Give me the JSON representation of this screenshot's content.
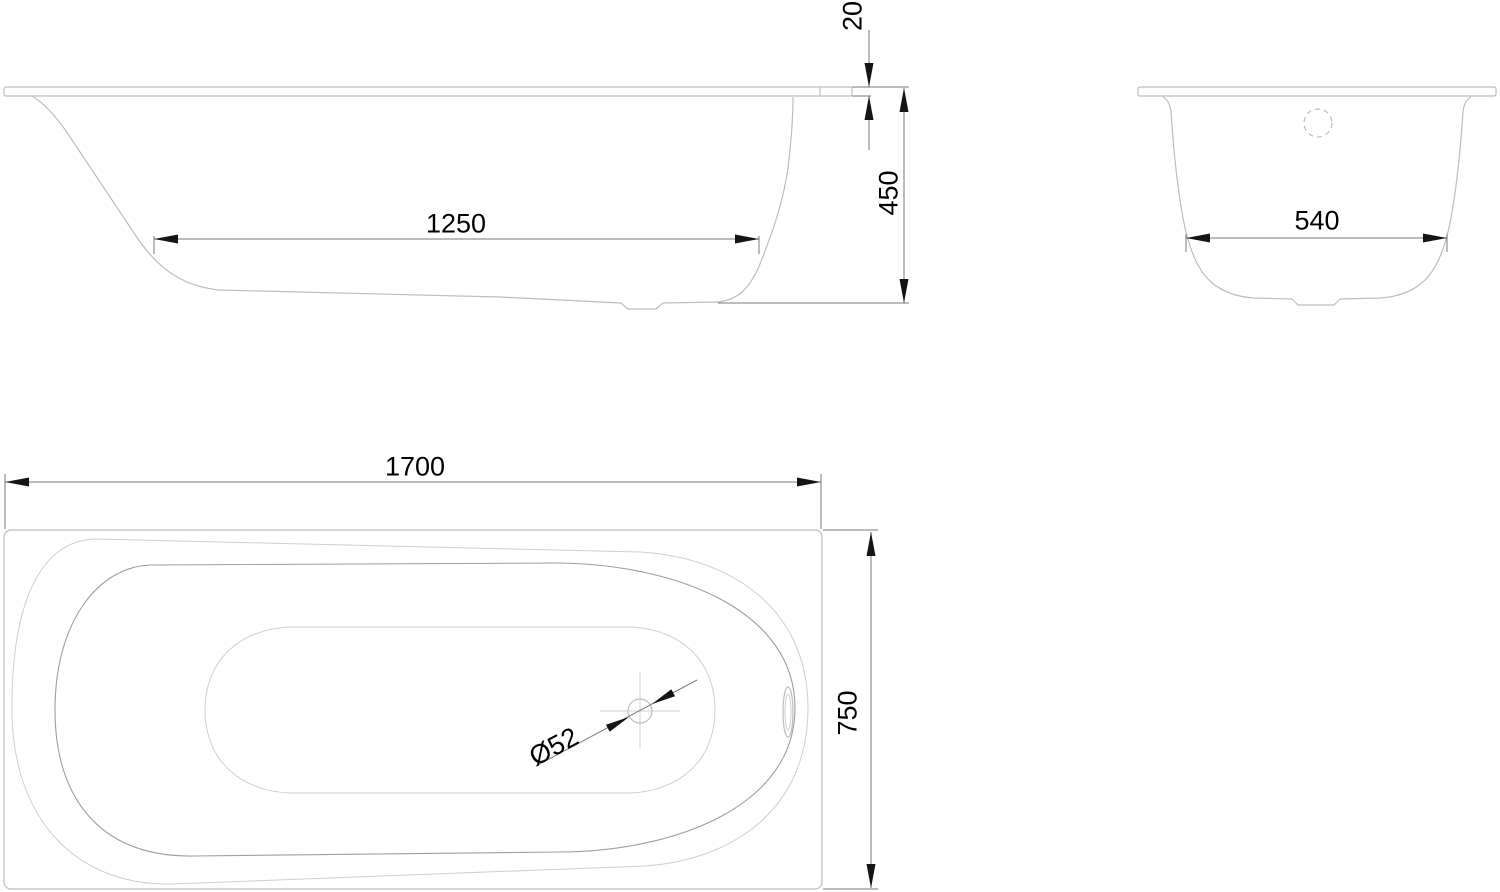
{
  "drawing": {
    "type": "bathtub-technical-drawing",
    "views": {
      "side_view": "side elevation",
      "end_view": "end section",
      "plan_view": "top plan"
    },
    "dims": {
      "d1250": "1250",
      "d20": "20",
      "d450": "450",
      "d540": "540",
      "d1700": "1700",
      "d750": "750",
      "d52": "Ø52"
    },
    "colors": {
      "background": "#ffffff",
      "geometry_line": "#bdbdbd",
      "geometry_line_dark": "#9e9e9e",
      "dimension_line": "#7a7a7a",
      "arrow": "#151515",
      "text": "#000000"
    }
  }
}
